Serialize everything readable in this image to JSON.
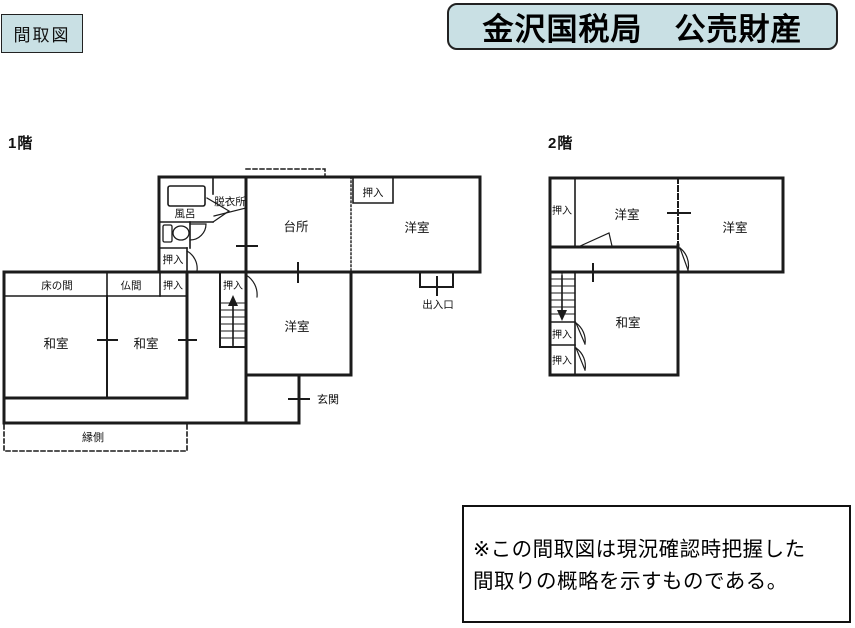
{
  "page": {
    "tag_label": "間取図",
    "title": "金沢国税局　公売財産"
  },
  "floor1": {
    "label": "1階",
    "rooms": {
      "bath": "風呂",
      "dressing": "脱衣所",
      "kitchen": "台所",
      "closet_kitchen": "押入",
      "western_ne": "洋室",
      "doorway": "出入口",
      "closet_bath": "押入",
      "tokonoma": "床の間",
      "butsuma": "仏間",
      "closet_row": "押入",
      "closet_stair": "押入",
      "washitsu_w": "和室",
      "washitsu_c": "和室",
      "western_mid": "洋室",
      "genkan": "玄関",
      "engawa": "縁側"
    }
  },
  "floor2": {
    "label": "2階",
    "rooms": {
      "closet_nw": "押入",
      "western_w": "洋室",
      "western_e": "洋室",
      "washitsu": "和室",
      "closet_mid": "押入",
      "closet_s": "押入"
    }
  },
  "note": {
    "line1": "※この間取図は現況確認時把握した",
    "line2": "間取りの概略を示すものである。"
  },
  "colors": {
    "header_fill": "#c9e0e4",
    "ink": "#1b1b1b"
  }
}
